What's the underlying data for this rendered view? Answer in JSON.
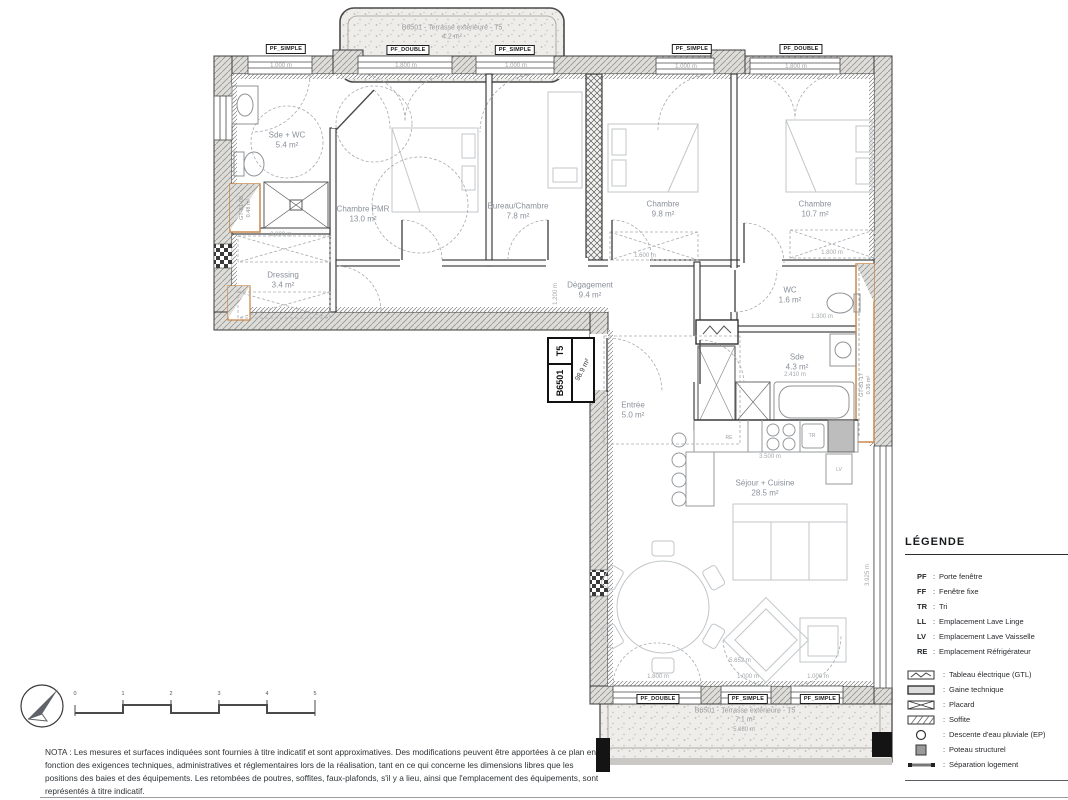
{
  "plan": {
    "unit_box": {
      "code": "B6501",
      "type": "T5",
      "area": "98.9 m²"
    },
    "rooms": [
      {
        "name": "Sde + WC",
        "area": "5.4 m²"
      },
      {
        "name": "Chambre PMR",
        "area": "13.0 m²"
      },
      {
        "name": "Bureau/Chambre",
        "area": "7.8 m²"
      },
      {
        "name": "Chambre",
        "area": "9.8 m²"
      },
      {
        "name": "Chambre",
        "area": "10.7 m²"
      },
      {
        "name": "Dressing",
        "area": "3.4 m²"
      },
      {
        "name": "Dégagement",
        "area": "9.4 m²"
      },
      {
        "name": "WC",
        "area": "1.6 m²"
      },
      {
        "name": "Sde",
        "area": "4.3 m²"
      },
      {
        "name": "Entrée",
        "area": "5.0 m²"
      },
      {
        "name": "Séjour + Cuisine",
        "area": "28.5 m²"
      }
    ],
    "terraces": [
      {
        "label": "B6501 - Terrasse extérieure - T5",
        "area": "4.2 m²"
      },
      {
        "label": "B6501 - Terrasse extérieure - T5",
        "area": "7.1 m²"
      }
    ],
    "window_tags": [
      "PF_SIMPLE",
      "PF_DOUBLE",
      "PF_SIMPLE",
      "PF_SIMPLE",
      "PF_DOUBLE",
      "PF_DOUBLE",
      "PF_SIMPLE",
      "PF_SIMPLE"
    ],
    "shafts": [
      {
        "label": "GT-B1-08",
        "area": "0.48 m²"
      },
      {
        "label": "GT-B1-17",
        "area": "0.36 m²"
      }
    ],
    "appliances": {
      "fridge": "RE",
      "waste": "TR",
      "dishwasher": "LV"
    },
    "dimensions": [
      "1.000 m",
      "1.800 m",
      "1.000 m",
      "1.000 m",
      "1.800 m",
      "2.000 m",
      "1.600 m",
      "1.800 m",
      "1.300 m",
      "2.410 m",
      "3.500 m",
      "1.800 m",
      "1.000 m",
      "1.000 m",
      "5.080 m",
      "3.925 m",
      "1.200 m",
      "5.652 m"
    ]
  },
  "legend": {
    "title": "LÉGENDE",
    "colon": ":",
    "abbreviations": [
      {
        "abbr": "PF",
        "label": "Porte fenêtre"
      },
      {
        "abbr": "FF",
        "label": "Fenêtre fixe"
      },
      {
        "abbr": "TR",
        "label": "Tri"
      },
      {
        "abbr": "LL",
        "label": "Emplacement Lave Linge"
      },
      {
        "abbr": "LV",
        "label": "Emplacement Lave Vaisselle"
      },
      {
        "abbr": "RE",
        "label": "Emplacement Réfrigérateur"
      }
    ],
    "symbols": [
      {
        "label": "Tableau électrique (GTL)"
      },
      {
        "label": "Gaine technique"
      },
      {
        "label": "Placard"
      },
      {
        "label": "Soffite"
      },
      {
        "label": "Descente d'eau pluviale (EP)"
      },
      {
        "label": "Poteau structurel"
      },
      {
        "label": "Séparation logement"
      }
    ]
  },
  "nota": "NOTA : Les mesures et surfaces indiquées sont fournies à titre indicatif et sont approximatives. Des modifications peuvent être apportées à ce plan en fonction des exigences techniques, administratives et réglementaires lors de la réalisation, tant en ce qui concerne les dimensions libres que les positions des baies et des équipements. Les retombées de poutres, soffites, faux-plafonds, s'il y a lieu, ainsi que l'emplacement des équipements, sont représentés à titre indicatif.",
  "scale_bar": {
    "ticks": [
      "0",
      "1",
      "2",
      "3",
      "4",
      "5"
    ]
  }
}
